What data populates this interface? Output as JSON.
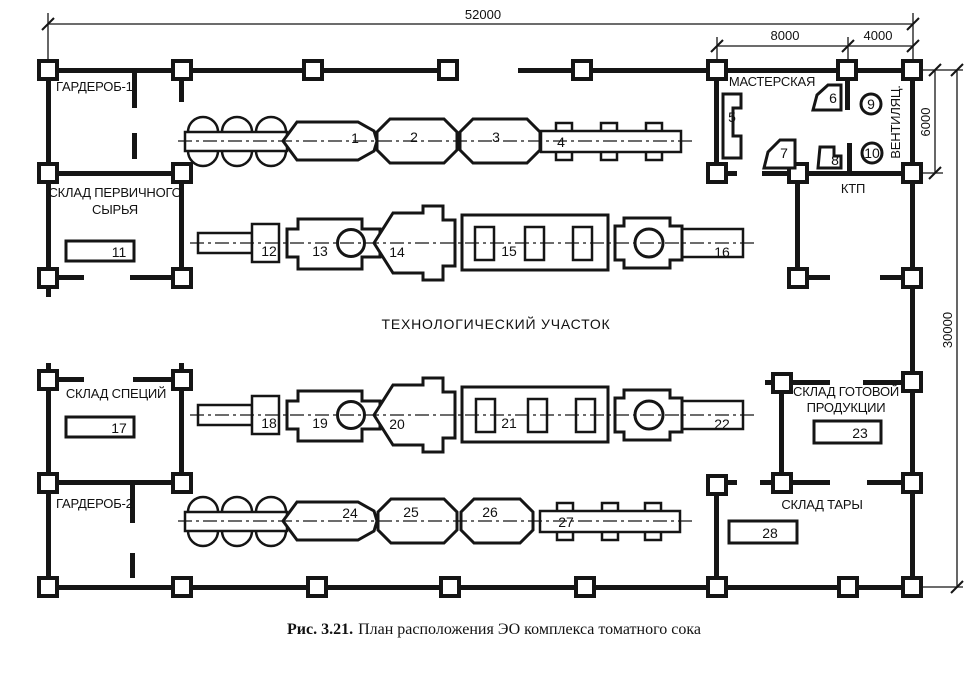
{
  "figure": {
    "caption_label": "Рис. 3.21.",
    "caption_text": "План расположения ЭО комплекса томатного сока"
  },
  "dimensions": {
    "total_width": "52000",
    "workshop_bay_width": "8000",
    "ventilation_bay_width": "4000",
    "service_bay_depth": "6000",
    "total_depth": "30000"
  },
  "rooms": {
    "garderob_1": "ГАРДЕРОБ-1",
    "sklad_pervichnogo_line1": "СКЛАД ПЕРВИЧНОГО",
    "sklad_pervichnogo_line2": "СЫРЬЯ",
    "masterskaya": "МАСТЕРСКАЯ",
    "ventilyatsionnaya": "ВЕНТИЛЯЦ.",
    "ktp": "КТП",
    "tekhnologicheskij_uchastok": "ТЕХНОЛОГИЧЕСКИЙ УЧАСТОК",
    "sklad_spetsij": "СКЛАД СПЕЦИЙ",
    "garderob_2": "ГАРДЕРОБ-2",
    "sklad_gotovoj_line1": "СКЛАД ГОТОВОЙ",
    "sklad_gotovoj_line2": "ПРОДУКЦИИ",
    "sklad_tary": "СКЛАД ТАРЫ"
  },
  "equipment": {
    "labels": [
      "1",
      "2",
      "3",
      "4",
      "5",
      "6",
      "7",
      "8",
      "9",
      "10",
      "11",
      "12",
      "13",
      "14",
      "15",
      "16",
      "17",
      "18",
      "19",
      "20",
      "21",
      "22",
      "23",
      "24",
      "25",
      "26",
      "27",
      "28"
    ]
  },
  "colors": {
    "ink": "#151515",
    "paper": "#ffffff"
  }
}
